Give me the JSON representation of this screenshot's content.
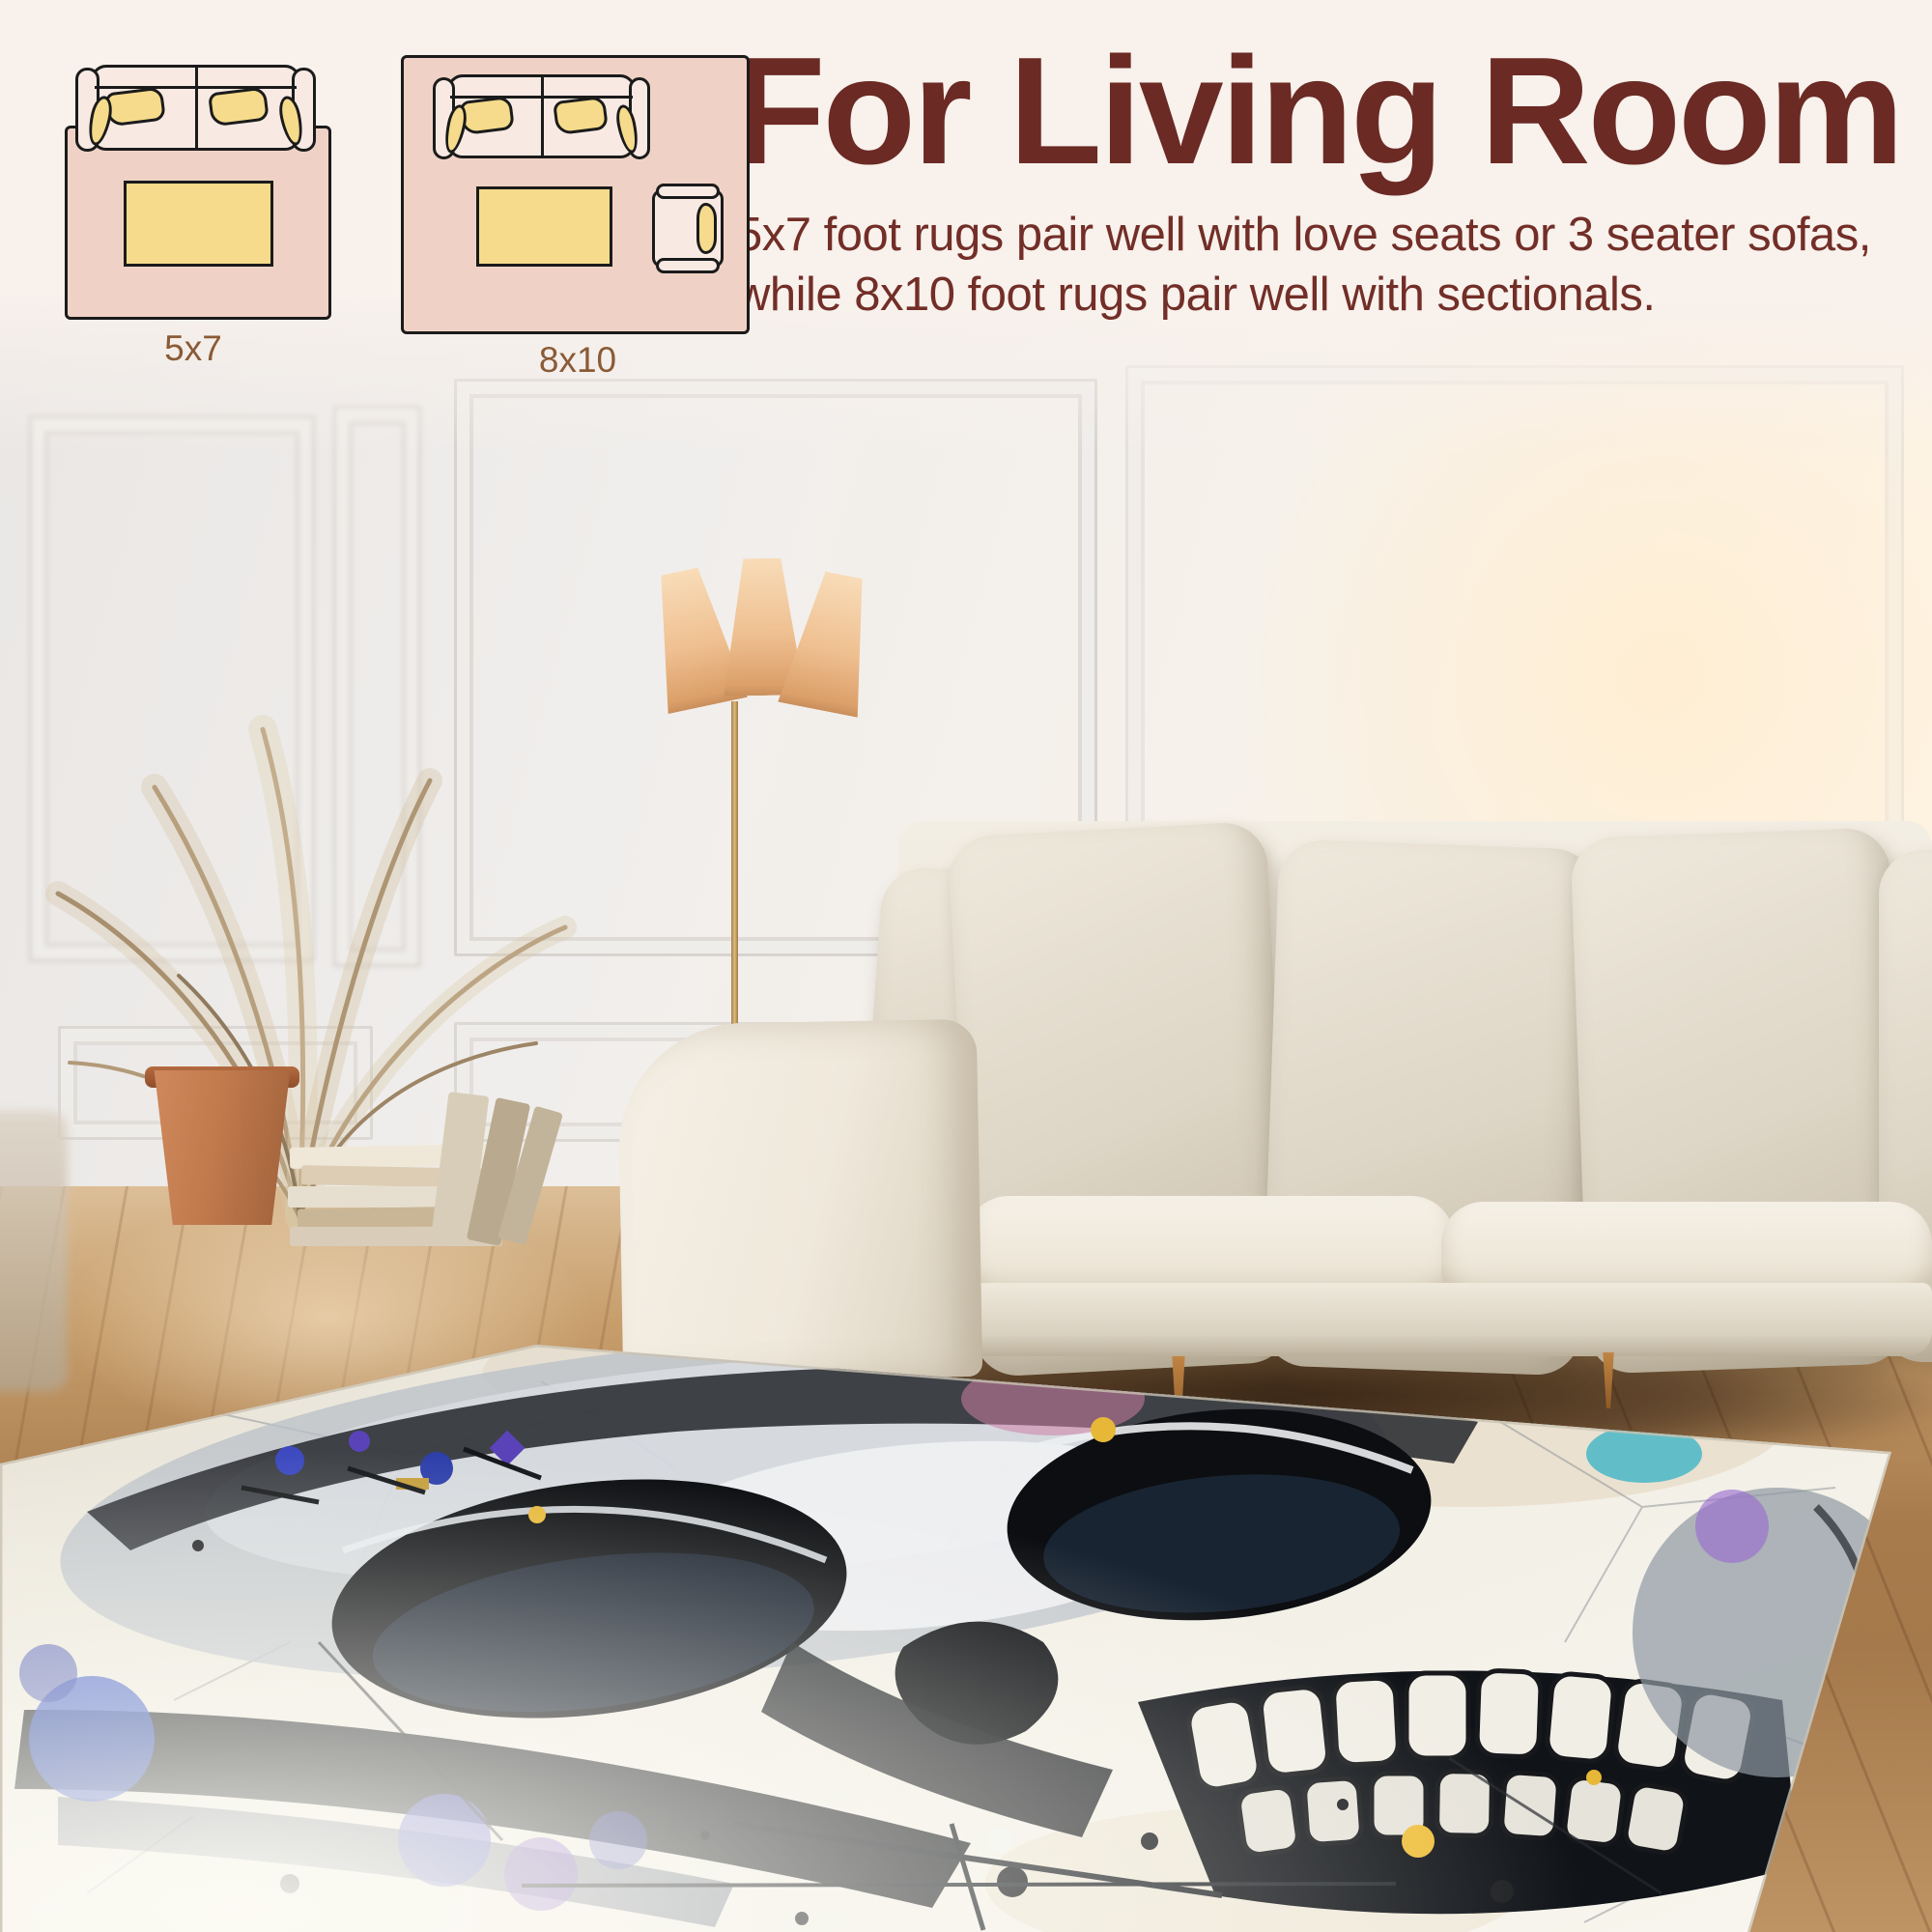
{
  "header": {
    "title": "For Living Room",
    "description": "5x7 foot rugs pair well with love seats or 3 seater sofas, while 8x10 foot rugs pair well with sectionals."
  },
  "size_guide": {
    "options": [
      {
        "label": "5x7",
        "furniture": [
          "loveseat-top-view",
          "coffee-table"
        ]
      },
      {
        "label": "8x10",
        "furniture": [
          "sofa-top-view",
          "coffee-table",
          "armchair-top-view"
        ]
      }
    ]
  },
  "scene": {
    "elements": [
      "white-paneled-wall",
      "floor-lamp",
      "dried-palm-plant",
      "terracotta-pot",
      "stacked-books",
      "cream-sofa",
      "beige-throw-pillows",
      "wood-floor",
      "watercolor-skull-area-rug"
    ]
  },
  "colors": {
    "band_bg": "#F8F1EC",
    "heading": "#6B2A24",
    "body_text": "#722E27",
    "label_text": "#8A5B36",
    "diagram_rug": "#EFD2C5",
    "diagram_furniture": "#F8E9E3",
    "diagram_accent": "#F5DB8B",
    "outline": "#1B1B1B",
    "rug_base": "#F2EFE6",
    "skull_ink": "#0C0E11",
    "splash_blue": "#3A57C8",
    "splash_purple": "#9A6FD0",
    "splash_teal": "#3FB5C6",
    "splash_magenta": "#CE7FA6",
    "splash_yellow": "#E7B838"
  }
}
